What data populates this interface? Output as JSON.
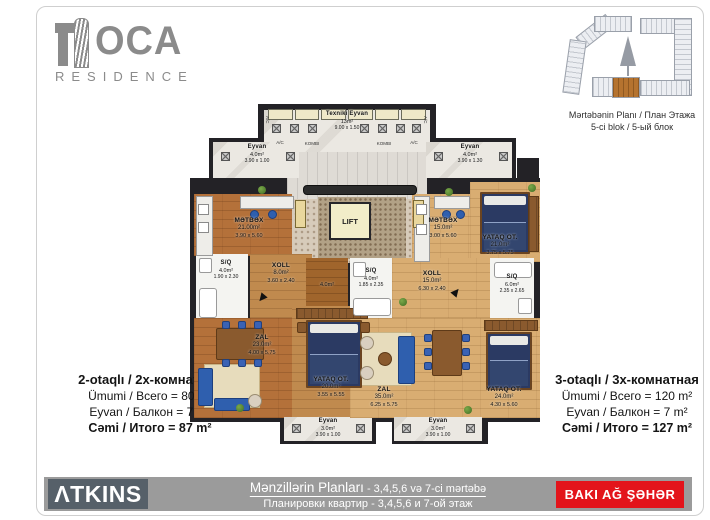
{
  "logo": {
    "name": "OCA",
    "subtitle": "RESIDENCE"
  },
  "site_plan": {
    "caption1": "Mərtəbənin Planı / План Этажа",
    "caption2": "5-ci blok / 5-ый блок",
    "highlight_color": "#b5732f"
  },
  "core": {
    "texniki": {
      "name": "Texniki Eyvan",
      "area": "13m²",
      "dims": "9.00 x 1.50"
    },
    "lift": "LIFT",
    "ac": "A/C",
    "kombi": "KOMBI"
  },
  "left_apt": {
    "eyvan_top": {
      "name": "Eyvan",
      "area": "4.0m²",
      "dims": "3.90 x 1.00"
    },
    "metbex": {
      "name": "MƏTBƏX",
      "area": "21.00m²",
      "dims": "3.90 x 5.60"
    },
    "sq": {
      "name": "S/Q",
      "area": "4.0m²",
      "dims": "1.90 x 2.30"
    },
    "xoll": {
      "name": "XOLL",
      "area": "8.0m²",
      "dims": "3.60 x 2.40"
    },
    "qarderob": {
      "area": "4.0m²"
    },
    "zal": {
      "name": "ZAL",
      "area": "23.0m²",
      "dims": "4.00 x 5.75"
    },
    "yataq": {
      "name": "YATAQ OT.",
      "area": "20.0m²",
      "dims": "3.55 x 5.55"
    },
    "eyvan_bottom": {
      "name": "Eyvan",
      "area": "3.0m²",
      "dims": "3.90 x 1.00"
    }
  },
  "right_apt": {
    "eyvan_top": {
      "name": "Eyvan",
      "area": "4.0m²",
      "dims": "3.90 x 1.30"
    },
    "metbex": {
      "name": "MƏTBƏX",
      "area": "15.0m²",
      "dims": "3.00 x 5.60"
    },
    "yataq_top": {
      "name": "YATAQ OT.",
      "area": "21.0m²",
      "dims": "3.75 x 5.75"
    },
    "sq_small": {
      "name": "S/Q",
      "area": "4.0m²",
      "dims": "1.85 x 2.35"
    },
    "xoll": {
      "name": "XOLL",
      "area": "15.0m²",
      "dims": "6.30 x 2.40"
    },
    "sq_big": {
      "name": "S/Q",
      "area": "6.0m²",
      "dims": "2.35 x 2.65"
    },
    "zal": {
      "name": "ZAL",
      "area": "35.0m²",
      "dims": "6.25 x 5.75"
    },
    "yataq_bottom": {
      "name": "YATAQ OT.",
      "area": "24.0m²",
      "dims": "4.30 x 5.60"
    },
    "eyvan_bottom": {
      "name": "Eyvan",
      "area": "3.0m²",
      "dims": "3.90 x 1.00"
    }
  },
  "summary_left": {
    "title": "2-otaqlı / 2х-комнатная",
    "line1": "Ümumi / Всего = 80 m²",
    "line2": "Eyvan / Балкон = 7 m²",
    "total": "Cəmi / Итого = 87 m²"
  },
  "summary_right": {
    "title": "3-otaqlı / 3х-комнатная",
    "line1": "Ümumi / Всего = 120 m²",
    "line2": "Eyvan / Балкон = 7 m²",
    "total": "Cəmi / Итого = 127 m²"
  },
  "footer": {
    "brand": "ΛTKINS",
    "title": "Mənzillərin Planları",
    "title_suffix": " - 3,4,5,6 və 7-ci mərtəbə",
    "subtitle": "Планировки квартир - 3,4,5,6 и 7-ой этаж",
    "badge": "BAKI AĞ ŞƏHƏR"
  },
  "colors": {
    "accent_red": "#e3141b",
    "wall": "#232226",
    "wood_dark": "#b4713a",
    "wood_light": "#d9ad72"
  }
}
